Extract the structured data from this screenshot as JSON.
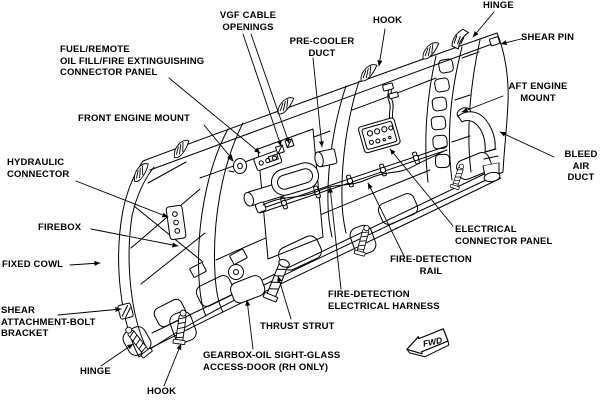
{
  "figure": {
    "kind": "technical-illustration",
    "subject": "aircraft engine fixed cowl structure (inner view)",
    "background_color": "#ffffff",
    "line_color": "#000000"
  },
  "callouts": [
    {
      "id": "vgf-cable-openings",
      "text": "VGF CABLE\nOPENINGS"
    },
    {
      "id": "pre-cooler-duct",
      "text": "PRE-COOLER\nDUCT"
    },
    {
      "id": "hook-top",
      "text": "HOOK"
    },
    {
      "id": "hinge-top",
      "text": "HINGE"
    },
    {
      "id": "shear-pin",
      "text": "SHEAR PIN"
    },
    {
      "id": "fuel-connector-panel",
      "text": "FUEL/REMOTE\nOIL FILL/FIRE EXTINGUISHING\nCONNECTOR PANEL"
    },
    {
      "id": "front-engine-mount",
      "text": "FRONT ENGINE MOUNT"
    },
    {
      "id": "aft-engine-mount",
      "text": "AFT ENGINE\nMOUNT"
    },
    {
      "id": "bleed-air-duct",
      "text": "BLEED\nAIR DUCT"
    },
    {
      "id": "hydraulic-connector",
      "text": "HYDRAULIC\nCONNECTOR"
    },
    {
      "id": "firebox",
      "text": "FIREBOX"
    },
    {
      "id": "electrical-connector-panel",
      "text": "ELECTRICAL\nCONNECTOR PANEL"
    },
    {
      "id": "fixed-cowl",
      "text": "FIXED COWL"
    },
    {
      "id": "fire-detection-rail",
      "text": "FIRE-DETECTION\nRAIL"
    },
    {
      "id": "fire-detection-harness",
      "text": "FIRE-DETECTION\nELECTRICAL HARNESS"
    },
    {
      "id": "shear-attachment-bolt-bracket",
      "text": "SHEAR\nATTACHMENT-BOLT\nBRACKET"
    },
    {
      "id": "thrust-strut",
      "text": "THRUST STRUT"
    },
    {
      "id": "hinge-bottom",
      "text": "HINGE"
    },
    {
      "id": "hook-bottom",
      "text": "HOOK"
    },
    {
      "id": "gearbox-access-door",
      "text": "GEARBOX-OIL SIGHT-GLASS\nACCESS-DOOR (RH ONLY)"
    }
  ],
  "fwd_marker": {
    "label": "FWD"
  }
}
